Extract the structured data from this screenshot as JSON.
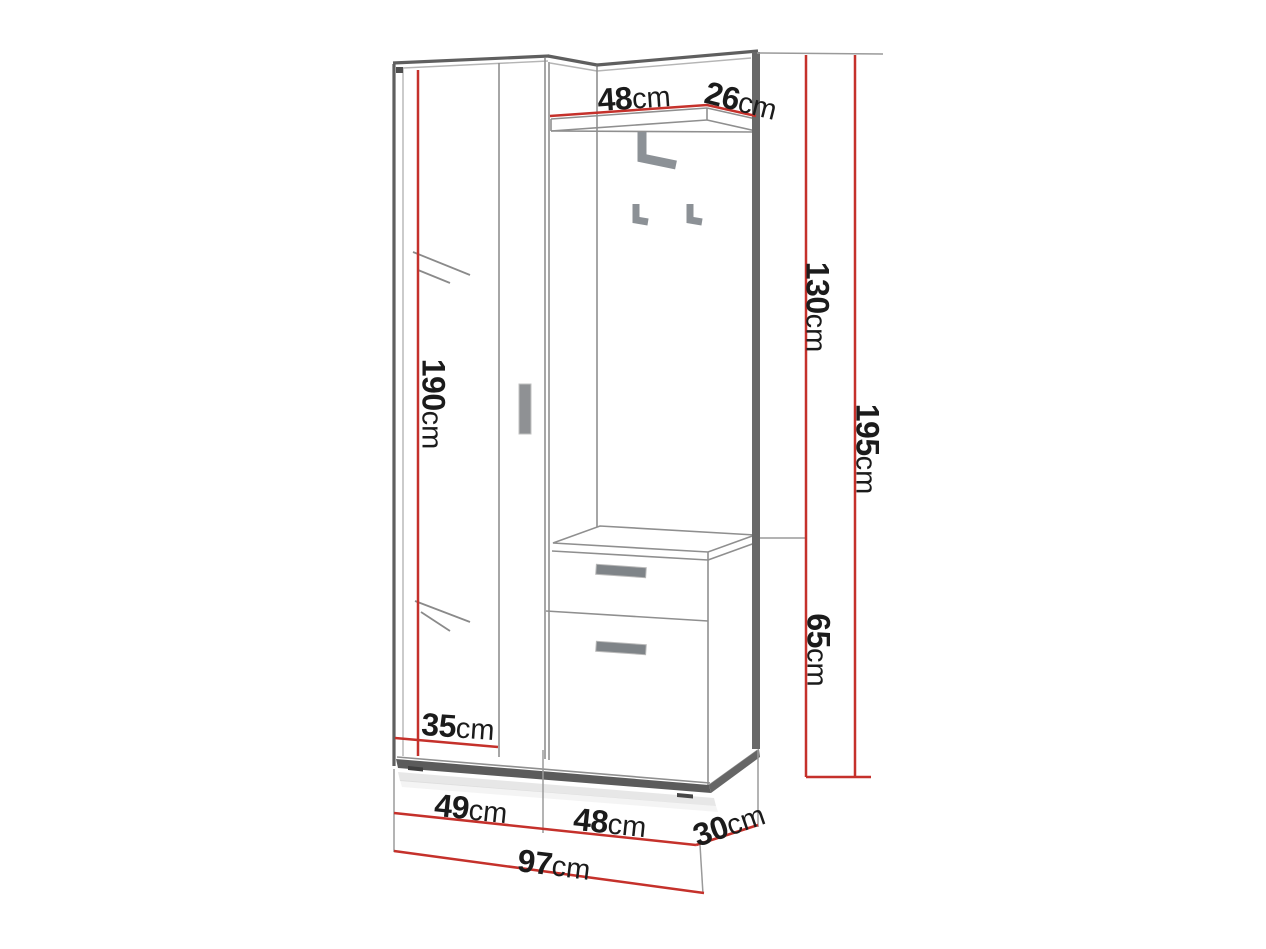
{
  "diagram": {
    "type": "furniture-dimension-drawing",
    "subject": "hallway wardrobe set with mirror, coat hooks, shelf and shoe cabinet",
    "unit": "cm",
    "colors": {
      "dimension_line": "#c5312b",
      "outline_dark": "#5f5f5f",
      "line_thin": "#909090",
      "hardware_gray": "#8f9499",
      "label_text": "#1b1b1b",
      "background": "#ffffff"
    },
    "dimensions": {
      "shelf_width": {
        "value": "48",
        "unit": "cm"
      },
      "shelf_depth": {
        "value": "26",
        "unit": "cm"
      },
      "upper_height": {
        "value": "130",
        "unit": "cm"
      },
      "total_height": {
        "value": "195",
        "unit": "cm"
      },
      "wardrobe_height": {
        "value": "190",
        "unit": "cm"
      },
      "cabinet_height": {
        "value": "65",
        "unit": "cm"
      },
      "mirror_width": {
        "value": "35",
        "unit": "cm"
      },
      "wardrobe_width": {
        "value": "49",
        "unit": "cm"
      },
      "cabinet_width": {
        "value": "48",
        "unit": "cm"
      },
      "unit_depth": {
        "value": "30",
        "unit": "cm"
      },
      "total_width": {
        "value": "97",
        "unit": "cm"
      }
    }
  }
}
